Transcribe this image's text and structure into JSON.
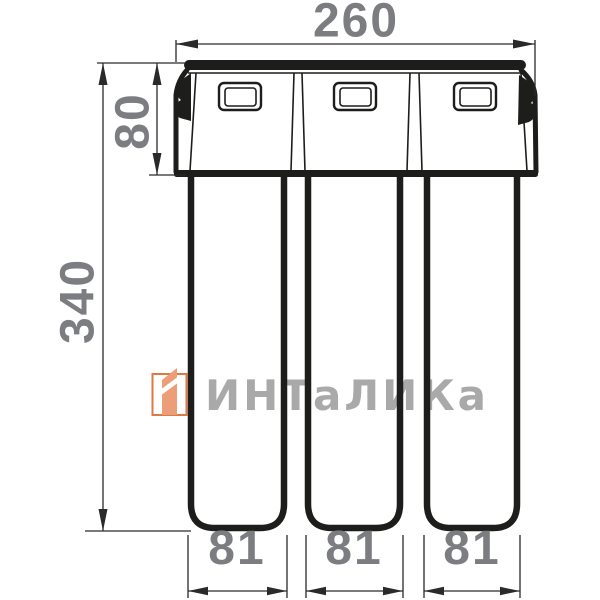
{
  "drawing": {
    "dim_overall_width": "260",
    "dim_head_height": "80",
    "dim_overall_height": "340",
    "dim_cartridge_widths": [
      "81",
      "81",
      "81"
    ]
  },
  "watermark": {
    "brand_text": "ИНТаЛИКа"
  },
  "colors": {
    "line": "#1d1d1b",
    "dimension_text": "#7b7d80",
    "watermark_text": "#a9a9a9",
    "logo_outline": "#dc7a44",
    "logo_fill": "#eb9e77",
    "background": "#ffffff"
  }
}
